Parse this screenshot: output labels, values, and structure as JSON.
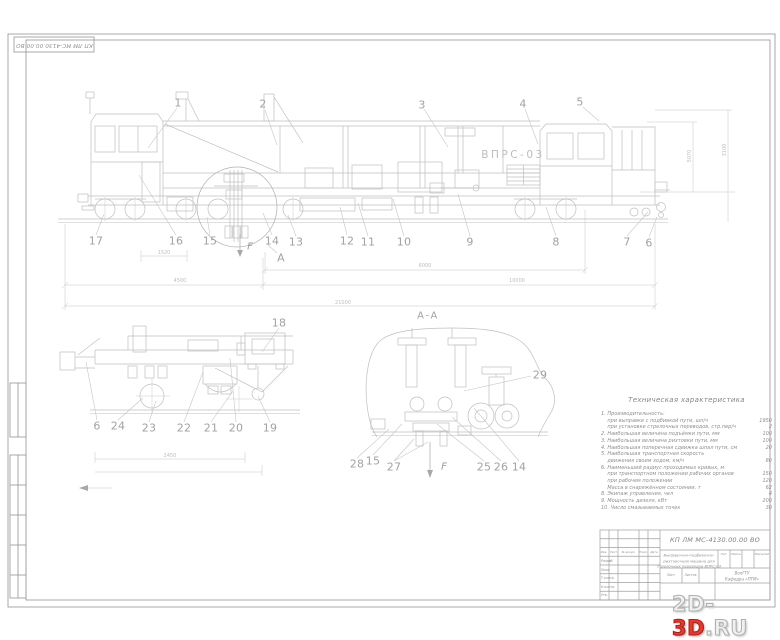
{
  "stamp_top": "КП ЛМ МС-4130.00.00 ВО",
  "main_view": {
    "machine_label": "ВПРС-03",
    "callouts_top": [
      "1",
      "2",
      "3",
      "4",
      "5"
    ],
    "callouts_bottom": [
      "17",
      "16",
      "15",
      "14",
      "13",
      "12",
      "11",
      "10",
      "9",
      "8",
      "7",
      "6"
    ],
    "detail_letter": "А",
    "force_label": "F",
    "dims": {
      "d1": "6000",
      "d2": "4500",
      "d3": "10000",
      "d4": "21000",
      "d5": "1520",
      "v1": "5070",
      "v2": "3100"
    }
  },
  "detail_view": {
    "callouts": [
      "18",
      "6",
      "24",
      "23",
      "22",
      "21",
      "20",
      "19"
    ],
    "dim": "2450"
  },
  "section_view": {
    "title": "А-А",
    "force_label": "F",
    "callouts": [
      "29",
      "28",
      "15",
      "27",
      "25",
      "26",
      "14"
    ]
  },
  "specs": {
    "title": "Техническая характеристика",
    "items": [
      {
        "text": "1. Производительность:",
        "value": ""
      },
      {
        "text": "    при выправке с подбивкой пути, шп/ч",
        "value": "1950"
      },
      {
        "text": "    при установке стрелочных переводов, стр.пер/ч",
        "value": "2"
      },
      {
        "text": "2. Наибольшая величина подъёмки пути, мм",
        "value": "100"
      },
      {
        "text": "3. Наибольшая величина рихтовки пути, мм",
        "value": "100"
      },
      {
        "text": "4. Наибольшая поперечная сдвижка шпал пути, см",
        "value": "20"
      },
      {
        "text": "5. Наибольшая транспортная скорость",
        "value": ""
      },
      {
        "text": "    движения своим ходом, км/ч",
        "value": "80"
      },
      {
        "text": "6. Наименьший радиус проходимых кривых, м",
        "value": ""
      },
      {
        "text": "    при транспортном положении рабочих органов",
        "value": "150"
      },
      {
        "text": "    при рабочем положении",
        "value": "120"
      },
      {
        "text": "    Масса в снаряжённом состоянии, т",
        "value": "62"
      },
      {
        "text": "8. Экипаж управления, чел",
        "value": "4"
      },
      {
        "text": "9. Мощность дизеля, кВт",
        "value": "200"
      },
      {
        "text": "10. Число смазываемых точек",
        "value": "30"
      }
    ]
  },
  "title_block": {
    "designation": "КП ЛМ МС-4130.00.00 ВО",
    "name_lines": [
      "Выправочно-подбивочно-",
      "рихтовочная машина для",
      "стрелочных переводов ВПРС-03"
    ],
    "org_lines": [
      "ВолГТУ",
      "Кафедра «ПТМ»"
    ],
    "header_cells": [
      "Изм.",
      "Лист",
      "№ докум.",
      "Подп.",
      "Дата"
    ],
    "sig_rows": [
      "Разраб.",
      "Пров.",
      "Т.контр.",
      "Н.контр.",
      "Утв."
    ],
    "labels": {
      "lit": "Лит.",
      "mass": "Масса",
      "scale": "Масштаб",
      "sheet": "Лист",
      "sheets": "Листов"
    }
  },
  "watermark": {
    "p1": "2D-",
    "p2": "3D",
    "p3": ".RU"
  }
}
